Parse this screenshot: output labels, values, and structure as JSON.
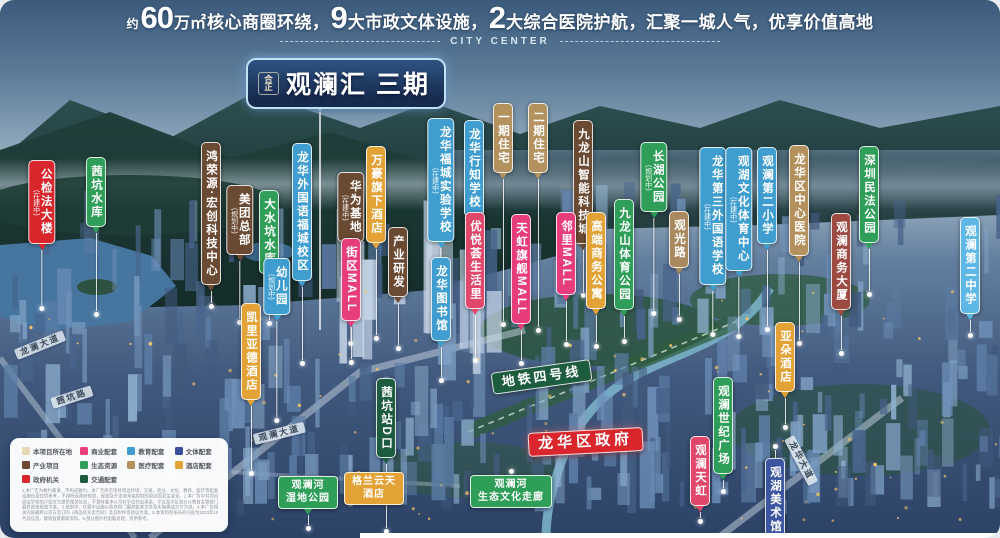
{
  "header": {
    "segments": [
      {
        "t": "约",
        "s": "small"
      },
      {
        "t": "60",
        "s": "big"
      },
      {
        "t": "万㎡",
        "s": "mid"
      },
      {
        "t": "核心商圈环绕，",
        "s": "norm"
      },
      {
        "t": "9",
        "s": "big"
      },
      {
        "t": "大市政文体设施，",
        "s": "norm"
      },
      {
        "t": "2",
        "s": "big"
      },
      {
        "t": "大综合医院护航，汇聚一城人气，优享价值高地",
        "s": "norm"
      }
    ],
    "subtitle": "CITY CENTER"
  },
  "banner": {
    "logo": "合正",
    "title": "观澜汇 三期"
  },
  "map": {
    "labels": [
      {
        "id": "gongjianfa-building",
        "text": "公检法大楼",
        "sub": "(在建中)",
        "color": "#d8262c",
        "x": 42,
        "y": 160,
        "line": 55
      },
      {
        "id": "qiankeng-reservoir",
        "text": "茜坑水库",
        "color": "#2f9e58",
        "x": 96,
        "y": 157,
        "line": 78
      },
      {
        "id": "hongrongyuan-tech-center",
        "text": "鸿荣源·宏创科技中心",
        "color": "#6b4a33",
        "x": 211,
        "y": 142,
        "line": 12
      },
      {
        "id": "meituan-hq",
        "text": "美团总部",
        "sub": "(规划中)",
        "color": "#6b4a33",
        "x": 240,
        "y": 185,
        "line": 58
      },
      {
        "id": "dashuikeng-reservoir",
        "text": "大水坑水库",
        "color": "#2f9e58",
        "x": 269,
        "y": 190,
        "line": 40
      },
      {
        "id": "longhua-foreign-lang-fucheng",
        "text": "龙华外国语福城校区",
        "color": "#3f9ecf",
        "x": 302,
        "y": 143,
        "line": 73
      },
      {
        "id": "kindergarten",
        "text": "幼儿园",
        "sub": "(规划中)",
        "color": "#3f9ecf",
        "x": 277,
        "y": 258,
        "line": 96
      },
      {
        "id": "kyriad-hotel",
        "text": "凯里亚德酒店",
        "color": "#e3a235",
        "x": 251,
        "y": 303,
        "line": 64
      },
      {
        "id": "huawei-base",
        "text": "华为基地",
        "sub": "(在建中)",
        "color": "#6b4a33",
        "x": 351,
        "y": 172,
        "line": 92
      },
      {
        "id": "marriott-hotel",
        "text": "万豪旗下酒店",
        "color": "#e3a235",
        "x": 376,
        "y": 146,
        "line": 86
      },
      {
        "id": "block-mall",
        "text": "街区MALL",
        "color": "#e83d7c",
        "x": 351,
        "y": 238,
        "line": 32
      },
      {
        "id": "industry-rd",
        "text": "产业研发",
        "color": "#6b4a33",
        "x": 398,
        "y": 227,
        "line": 42
      },
      {
        "id": "longhua-fucheng-school",
        "text": "龙华福城实验学校",
        "sub": "(在建中)",
        "color": "#3f9ecf",
        "x": 441,
        "y": 118,
        "line": 10
      },
      {
        "id": "longhua-xingzhi-school",
        "text": "龙华行知学校",
        "color": "#3f9ecf",
        "x": 474,
        "y": 120,
        "line": 28
      },
      {
        "id": "phase1-residence",
        "text": "一期住宅",
        "color": "#b3925f",
        "x": 503,
        "y": 103,
        "line": 142
      },
      {
        "id": "phase2-residence",
        "text": "二期住宅",
        "color": "#b3925f",
        "x": 538,
        "y": 103,
        "line": 148
      },
      {
        "id": "jiulongshan-tech-city",
        "text": "九龙山智能科技城",
        "color": "#6b4a33",
        "x": 583,
        "y": 120,
        "line": 42
      },
      {
        "id": "youyuehui-life",
        "text": "优悦荟生活里",
        "color": "#e0476b",
        "x": 475,
        "y": 212,
        "line": 42
      },
      {
        "id": "rainbow-flagship-mall",
        "text": "天虹旗舰MALL",
        "color": "#e83d7c",
        "x": 521,
        "y": 214,
        "line": 30
      },
      {
        "id": "linli-mall",
        "text": "邻里MALL",
        "color": "#e83d7c",
        "x": 566,
        "y": 212,
        "line": 40
      },
      {
        "id": "business-apartment",
        "text": "高端商务公寓",
        "color": "#e3a235",
        "x": 596,
        "y": 212,
        "line": 28
      },
      {
        "id": "jiulongshan-sports-park",
        "text": "九龙山体育公园",
        "color": "#2f9e58",
        "x": 624,
        "y": 199,
        "line": 22
      },
      {
        "id": "longhua-library",
        "text": "龙华图书馆",
        "color": "#3f9ecf",
        "x": 441,
        "y": 257,
        "line": 30
      },
      {
        "id": "guanguang-road",
        "text": "观光路",
        "color": "#a98a5f",
        "x": 679,
        "y": 211,
        "line": 42
      },
      {
        "id": "changhu-park",
        "text": "长湖公园",
        "sub": "(规划中)",
        "color": "#2f9e58",
        "x": 654,
        "y": 142,
        "line": 92
      },
      {
        "id": "longhua-3rd-foreign-school",
        "text": "龙华第三外国语学校",
        "sub": "(在建中)",
        "color": "#3f9ecf",
        "x": 713,
        "y": 147,
        "line": 40
      },
      {
        "id": "guanhu-culture-sports-center",
        "text": "观湖文化体育中心",
        "sub": "(在建中)",
        "color": "#3f9ecf",
        "x": 739,
        "y": 147,
        "line": 56
      },
      {
        "id": "guanlan-2nd-primary",
        "text": "观澜第二小学",
        "color": "#3f9ecf",
        "x": 767,
        "y": 147,
        "line": 76
      },
      {
        "id": "longhua-central-hospital",
        "text": "龙华区中心医院",
        "color": "#b3905c",
        "x": 799,
        "y": 145,
        "line": 78
      },
      {
        "id": "guanlan-business-tower",
        "text": "观澜商务大厦",
        "color": "#9c4a42",
        "x": 841,
        "y": 213,
        "line": 34
      },
      {
        "id": "shenzhen-minfa-park",
        "text": "深圳民法公园",
        "color": "#2f9e58",
        "x": 869,
        "y": 146,
        "line": 42
      },
      {
        "id": "guanlan-2nd-middle",
        "text": "观澜第二中学",
        "color": "#5fb7e5",
        "x": 970,
        "y": 217,
        "line": 12
      },
      {
        "id": "atour-hotel",
        "text": "亚朵酒店",
        "color": "#e3a235",
        "x": 785,
        "y": 322,
        "line": 26
      },
      {
        "id": "guanlan-century-plaza",
        "text": "观澜世纪广场",
        "color": "#2f9e58",
        "x": 723,
        "y": 377,
        "line": 8
      },
      {
        "id": "guanlan-rainbow",
        "text": "观澜天虹",
        "color": "#e0476b",
        "x": 700,
        "y": 436,
        "line": 6
      },
      {
        "id": "guanhu-art-museum",
        "text": "观湖美术馆",
        "color": "#3c55a0",
        "x": 775,
        "y": 443,
        "line": 8,
        "dotTop": true
      },
      {
        "id": "qiankeng-station-exit-d",
        "text": "茜坑站D口",
        "color": "#1d5c3f",
        "x": 386,
        "y": 378,
        "line": 64
      },
      {
        "id": "metro-line-4",
        "text": "地铁四号线",
        "color": "#1d5c3f",
        "x": 540,
        "y": 366,
        "kind": "h",
        "rot": -8
      },
      {
        "id": "longhua-district-government",
        "text": "龙华区政府",
        "color": "#d8262c",
        "x": 585,
        "y": 430,
        "kind": "h",
        "rot": -3,
        "big": true
      },
      {
        "id": "guanlan-river-wetland-park",
        "text": "观澜河\n湿地公园",
        "color": "#2f9e58",
        "x": 308,
        "y": 476,
        "kind": "h2",
        "line": 10
      },
      {
        "id": "grand-skylight-hotel",
        "text": "格兰云天\n酒店",
        "color": "#e3a235",
        "x": 374,
        "y": 472,
        "kind": "h2"
      },
      {
        "id": "guanlan-river-eco-corridor",
        "text": "观澜河\n生态文化走廊",
        "color": "#2f9e58",
        "x": 511,
        "y": 468,
        "kind": "h2",
        "dotTop": true
      },
      {
        "id": "longlan-avenue",
        "text": "龙澜大道",
        "x": 38,
        "y": 340,
        "kind": "road",
        "rot": -22
      },
      {
        "id": "qiankeng-road",
        "text": "茜坑路",
        "x": 70,
        "y": 392,
        "kind": "road",
        "rot": -18
      },
      {
        "id": "guanlan-avenue",
        "text": "观澜大道",
        "x": 278,
        "y": 428,
        "kind": "road",
        "rot": -14
      },
      {
        "id": "longhua-avenue",
        "text": "龙华大道",
        "x": 806,
        "y": 458,
        "kind": "road",
        "rot": 62
      }
    ]
  },
  "legend": {
    "items": [
      {
        "label": "本项目所在地",
        "color": "#e7d9b4"
      },
      {
        "label": "商业配套",
        "color": "#e83d7c"
      },
      {
        "label": "教育配套",
        "color": "#3f9ecf"
      },
      {
        "label": "文体配套",
        "color": "#3b4f9e"
      },
      {
        "label": "产业项目",
        "color": "#6b4a33"
      },
      {
        "label": "生态资源",
        "color": "#2f9e58"
      },
      {
        "label": "医疗配套",
        "color": "#b3905c"
      },
      {
        "label": "酒店配套",
        "color": "#e3a235"
      },
      {
        "label": "政府机关",
        "color": "#d8262c"
      },
      {
        "label": "交通配套",
        "color": "#1d5c3f"
      }
    ],
    "disclaimer": "1.本广告为要约邀请，不构成要约。本广告所示项目周边环境、交通、商业、文化、教育、医疗等配套设施信息仅供参考，不排除因政府规划、规定及开发商未能控制的原因而发生变化。2.本广告中对项目周边学校的介绍仅为提供相关信息，不意味着本公司对学位作出承诺，学位及学区划分以教育主管部门最终政策规定为准。3.规划中、在建中设施以政府部门最终批准文件及实际建成交付为准。4.本广告相关内容最终以双方签订的《商品房买卖合同》及其附件等协议为准。5.本资料所发布的内容为2023年10月前信息，敬请留意最新资料。6.部分图片经电脑处理，仅供参考。"
  }
}
